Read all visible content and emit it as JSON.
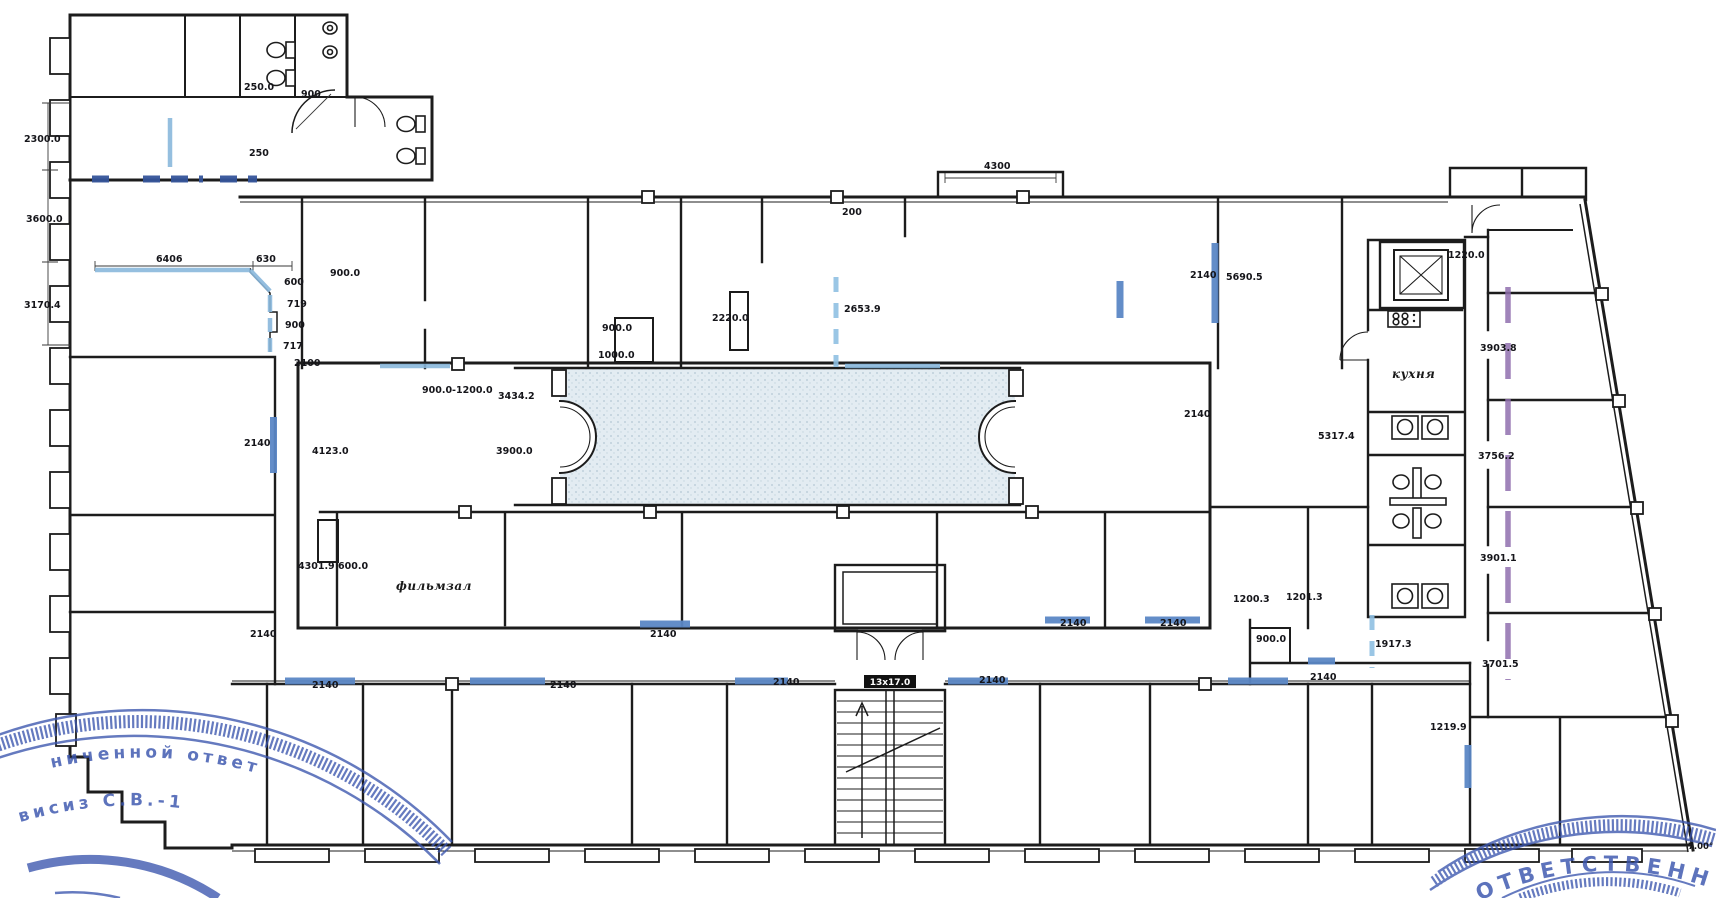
{
  "colors": {
    "wall": "#1c1c1c",
    "window_highlight": "#5b87c5",
    "dashed_partition_dark": "#35549a",
    "partition_light_blue": "#8ab8dc",
    "purple_line": "#8f6fae",
    "corridor_fill": "#e3ecf2",
    "stamp_blue": "#3a55ae"
  },
  "labels": [
    {
      "text": "2300.0",
      "x": 24,
      "y": 142
    },
    {
      "text": "3600.0",
      "x": 26,
      "y": 222
    },
    {
      "text": "3170.4",
      "x": 24,
      "y": 308
    },
    {
      "text": "250.0",
      "x": 244,
      "y": 90
    },
    {
      "text": "900",
      "x": 301,
      "y": 97
    },
    {
      "text": "250",
      "x": 249,
      "y": 156
    },
    {
      "text": "6406",
      "x": 156,
      "y": 262
    },
    {
      "text": "630",
      "x": 256,
      "y": 262
    },
    {
      "text": "600",
      "x": 284,
      "y": 285
    },
    {
      "text": "719",
      "x": 287,
      "y": 307
    },
    {
      "text": "900",
      "x": 285,
      "y": 328
    },
    {
      "text": "717",
      "x": 283,
      "y": 349
    },
    {
      "text": "900.0",
      "x": 330,
      "y": 276
    },
    {
      "text": "2100",
      "x": 294,
      "y": 366
    },
    {
      "text": "900.0",
      "x": 602,
      "y": 331
    },
    {
      "text": "1000.0",
      "x": 598,
      "y": 358
    },
    {
      "text": "2220.0",
      "x": 712,
      "y": 321
    },
    {
      "text": "2653.9",
      "x": 844,
      "y": 312
    },
    {
      "text": "4300",
      "x": 984,
      "y": 169
    },
    {
      "text": "200",
      "x": 842,
      "y": 215
    },
    {
      "text": "2140",
      "x": 1190,
      "y": 278
    },
    {
      "text": "5690.5",
      "x": 1226,
      "y": 280
    },
    {
      "text": "1220.0",
      "x": 1448,
      "y": 258
    },
    {
      "text": "3903.8",
      "x": 1480,
      "y": 351
    },
    {
      "text": "3756.2",
      "x": 1478,
      "y": 459
    },
    {
      "text": "3901.1",
      "x": 1480,
      "y": 561
    },
    {
      "text": "3701.5",
      "x": 1482,
      "y": 667
    },
    {
      "text": "1219.9",
      "x": 1430,
      "y": 730
    },
    {
      "text": "5317.4",
      "x": 1318,
      "y": 439
    },
    {
      "text": "2140",
      "x": 1184,
      "y": 417
    },
    {
      "text": "900.0-1200.0",
      "x": 422,
      "y": 393
    },
    {
      "text": "3434.2",
      "x": 498,
      "y": 399
    },
    {
      "text": "3900.0",
      "x": 496,
      "y": 454
    },
    {
      "text": "4123.0",
      "x": 312,
      "y": 454
    },
    {
      "text": "2140",
      "x": 244,
      "y": 446
    },
    {
      "text": "4301.9",
      "x": 298,
      "y": 569
    },
    {
      "text": "600.0",
      "x": 338,
      "y": 569
    },
    {
      "text": "фильмзал",
      "x": 396,
      "y": 590,
      "cls": "room",
      "name": "room-label-film-hall"
    },
    {
      "text": "кухня",
      "x": 1392,
      "y": 378,
      "cls": "room",
      "name": "room-label-kitchen"
    },
    {
      "text": "2140",
      "x": 250,
      "y": 637
    },
    {
      "text": "2140",
      "x": 650,
      "y": 637
    },
    {
      "text": "2140",
      "x": 1060,
      "y": 626
    },
    {
      "text": "2140",
      "x": 1160,
      "y": 626
    },
    {
      "text": "1200.3",
      "x": 1233,
      "y": 602
    },
    {
      "text": "1201.3",
      "x": 1286,
      "y": 600
    },
    {
      "text": "900.0",
      "x": 1256,
      "y": 642
    },
    {
      "text": "1917.3",
      "x": 1375,
      "y": 647
    },
    {
      "text": "2140",
      "x": 312,
      "y": 688
    },
    {
      "text": "2140",
      "x": 550,
      "y": 688
    },
    {
      "text": "2140",
      "x": 773,
      "y": 685
    },
    {
      "text": "2140",
      "x": 979,
      "y": 683
    },
    {
      "text": "2140",
      "x": 1310,
      "y": 680
    },
    {
      "text": "13х17.0",
      "x": 890,
      "y": 685,
      "cls": "stair",
      "name": "stair-run-label"
    },
    {
      "text": "7.00°",
      "x": 1688,
      "y": 849,
      "cls": "small",
      "name": "angle-label"
    }
  ],
  "stamps": {
    "left": {
      "arc_text": "ниченной ответ",
      "inner_text": "висиз С.В.-1"
    },
    "right": {
      "arc_text": "ОТВЕТСТВЕННОС"
    }
  }
}
